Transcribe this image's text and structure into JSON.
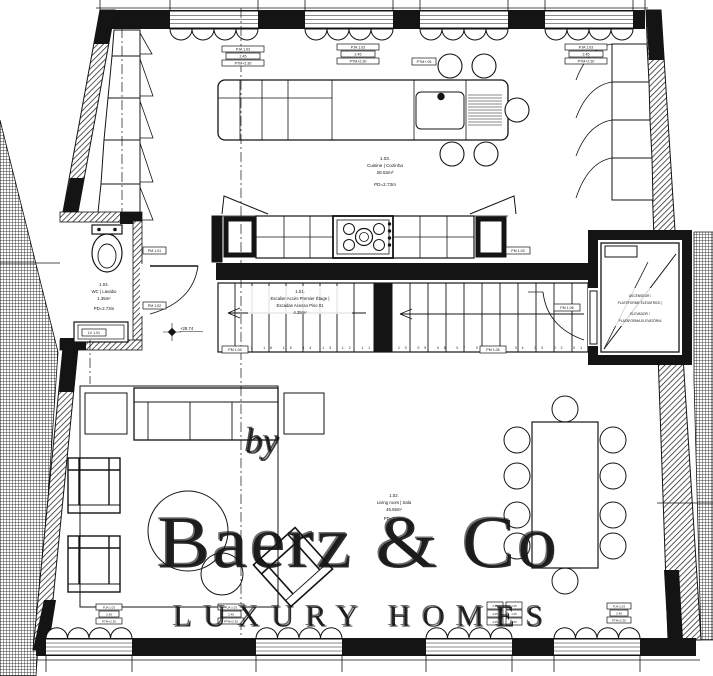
{
  "plan": {
    "rooms": {
      "stairs": {
        "num": "1.01.",
        "name_fr": "Escalier Accès Premier Étage |",
        "name_pt": "Escadas Acesso Piso 01",
        "area": "4.35m²"
      },
      "living": {
        "num": "1.02.",
        "name": "Living room | Sala",
        "area": "45.55m²",
        "height": "PD=2.73m"
      },
      "kitchen": {
        "num": "1.03.",
        "name": "Cuisine | Cozinha",
        "area": "28.52m²",
        "height": "PD=2.73m"
      },
      "wc": {
        "num": "1.04.",
        "name": "WC | Lavabo",
        "area": "1.35m²",
        "height": "PD=2.73m"
      },
      "elevator": {
        "l1": "ASCENSEUR /",
        "l2": "PLATEFORME ÉLÉVATRICE |",
        "l3": "ELEVADOR /",
        "l4": "PLATAFORMA ELEVATÓRIA"
      }
    },
    "level_marker": "+28.74",
    "stair_numbers": {
      "left": "18 17 16 15 14 13 12 11",
      "right": "10 09 08 07 06 05 04 03 02 01"
    },
    "tags": {
      "rows": [
        "PJA 1.03",
        "2.45",
        "PTM+2.30"
      ],
      "pm": [
        "PM 1.01",
        "PM 1.02",
        "PM 1.03",
        "PM 1.04",
        "PM 1.05",
        "PM 1.06"
      ],
      "lv": "LV 1.01",
      "ptm": "PTM+.05"
    }
  },
  "watermark": {
    "by": "by",
    "brand": "Baerz & Co",
    "tagline": "LUXURY HOMES"
  },
  "colors": {
    "line": "#141414",
    "watermark": "#c4c4c4"
  }
}
